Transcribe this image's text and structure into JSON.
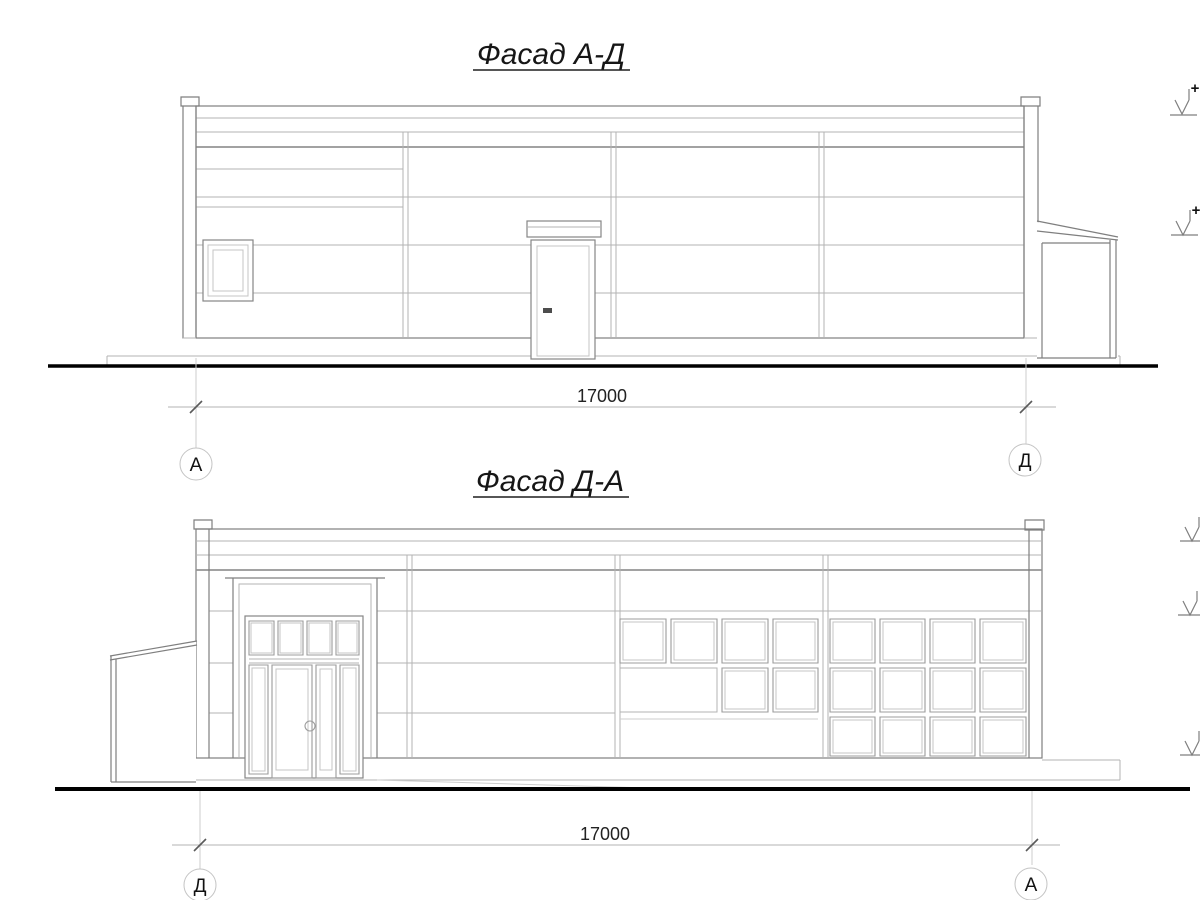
{
  "drawing": {
    "facade1": {
      "title": "Фасад А-Д",
      "dimension": "17000",
      "axis_left": "А",
      "axis_right": "Д",
      "plus_top": "+",
      "plus_mid": "+"
    },
    "facade2": {
      "title": "Фасад Д-А",
      "dimension": "17000",
      "axis_left": "Д",
      "axis_right": "А"
    }
  },
  "colors": {
    "background": "#ffffff",
    "main_line": "#7f7f7f",
    "light_line": "#b3b3b3",
    "ground_line": "#000000",
    "text": "#161616"
  }
}
